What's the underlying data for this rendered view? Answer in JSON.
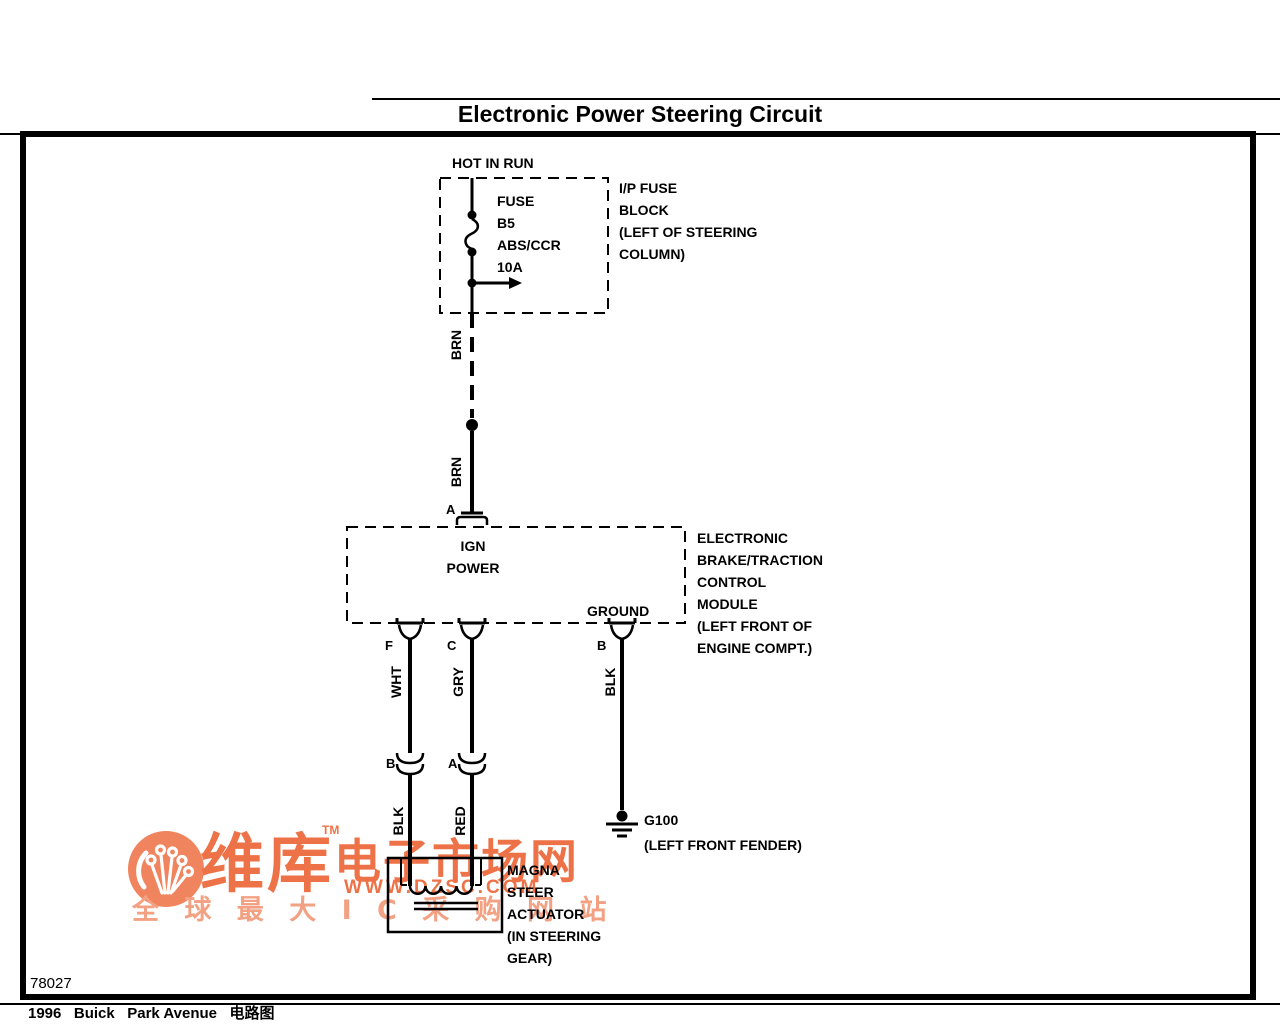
{
  "header": {
    "title": "Electronic Power Steering Circuit"
  },
  "fuse_block": {
    "feed_label": "HOT IN RUN",
    "name": "FUSE",
    "position": "B5",
    "circuit": "ABS/CCR",
    "rating": "10A",
    "location_lines": [
      "I/P FUSE",
      "BLOCK",
      "(LEFT OF STEERING",
      "COLUMN)"
    ]
  },
  "wires": {
    "brn_upper": "BRN",
    "brn_lower": "BRN",
    "wht": "WHT",
    "gry": "GRY",
    "blk_ground": "BLK",
    "blk_actuator": "BLK",
    "red": "RED"
  },
  "module": {
    "pin_a": "A",
    "pin_f": "F",
    "pin_c": "C",
    "pin_b": "B",
    "function_line1": "IGN",
    "function_line2": "POWER",
    "ground_label": "GROUND",
    "name_lines": [
      "ELECTRONIC",
      "BRAKE/TRACTION",
      "CONTROL",
      "MODULE",
      "(LEFT FRONT OF",
      "ENGINE COMPT.)"
    ]
  },
  "inline_connectors": {
    "wht_pin": "B",
    "gry_pin": "A"
  },
  "ground": {
    "id": "G100",
    "location": "(LEFT FRONT FENDER)"
  },
  "actuator": {
    "name_lines": [
      "MAGNA",
      "STEER",
      "ACTUATOR",
      "(IN STEERING",
      "GEAR)"
    ]
  },
  "footer": {
    "diagram_number": "78027",
    "caption": "1996   Buick   Park Avenue   电路图"
  },
  "watermark": {
    "brand": "维库",
    "tm": "TM",
    "brand_suffix": "电子市场网",
    "url": "WWW.DZSC.COM",
    "slogan": "全 球 最 大 I C 采 购 网 站",
    "colors": {
      "primary": "#ee7248",
      "light": "#f2a183",
      "logo_bg": "#f0845e",
      "line": "#000000"
    }
  }
}
